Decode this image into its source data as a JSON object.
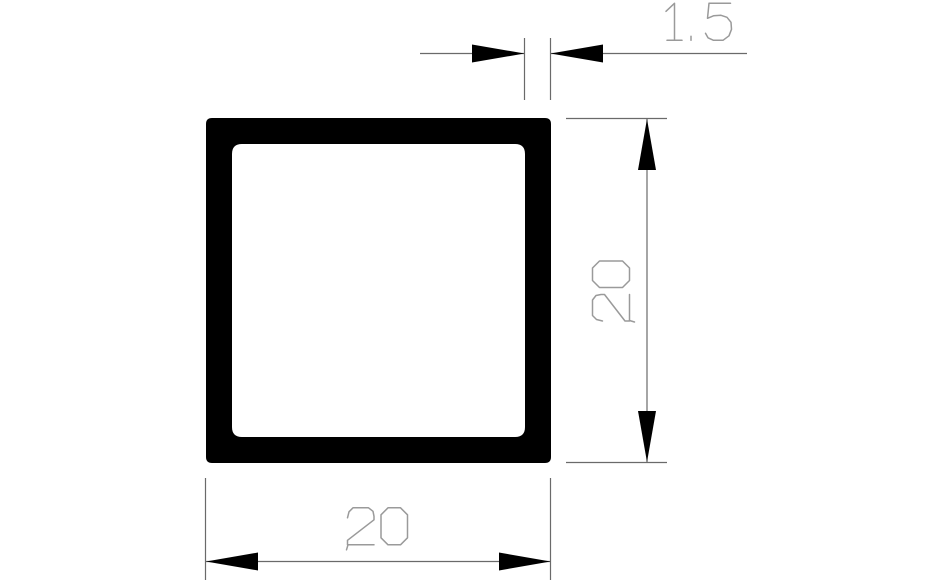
{
  "drawing": {
    "type": "technical-drawing",
    "subject": "Square hollow tube cross-section 20 x 20 x 1.5",
    "background_color": "#ffffff",
    "profile_color": "#000000",
    "dimension_line_color": "#6a6a6a",
    "dimension_text_color": "#9a9a9a",
    "dimensions": {
      "wall_thickness": {
        "label": "1.5",
        "value": 1.5,
        "position": "top"
      },
      "outer_height": {
        "label": "20",
        "value": 20,
        "position": "right"
      },
      "outer_width": {
        "label": "20",
        "value": 20,
        "position": "bottom"
      }
    }
  }
}
